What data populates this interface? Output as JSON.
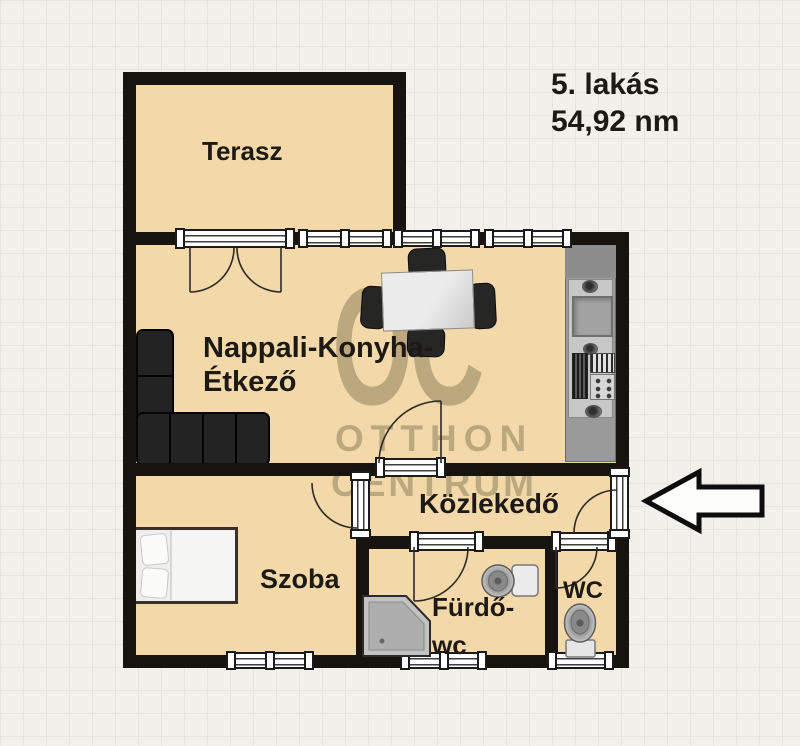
{
  "title": {
    "line1": "5. lakás",
    "line2": "54,92 nm"
  },
  "rooms": {
    "terasz": {
      "label": "Terasz"
    },
    "nappali": {
      "label_line1": "Nappali-Konyha-",
      "label_line2": "Étkező"
    },
    "kozlekedo": {
      "label": "Közlekedő"
    },
    "szoba": {
      "label": "Szoba"
    },
    "furdo": {
      "label_line1": "Fürdő-",
      "label_line2": "wc"
    },
    "wc": {
      "label": "WC"
    }
  },
  "watermark": {
    "logo": "OC",
    "line1": "OTTHON",
    "line2": "CENTRUM"
  },
  "icons": {
    "entrance_arrow": "left-arrow"
  },
  "colors": {
    "floor": "#f3d9a9",
    "wall": "#17130f",
    "background": "#f2f0ea",
    "grid_line": "#e7e4dc",
    "watermark": "#7a6c4c",
    "kitchen_counter": "#9a9a9a",
    "furniture_dark": "#212121",
    "label_text": "#1d1a16"
  }
}
